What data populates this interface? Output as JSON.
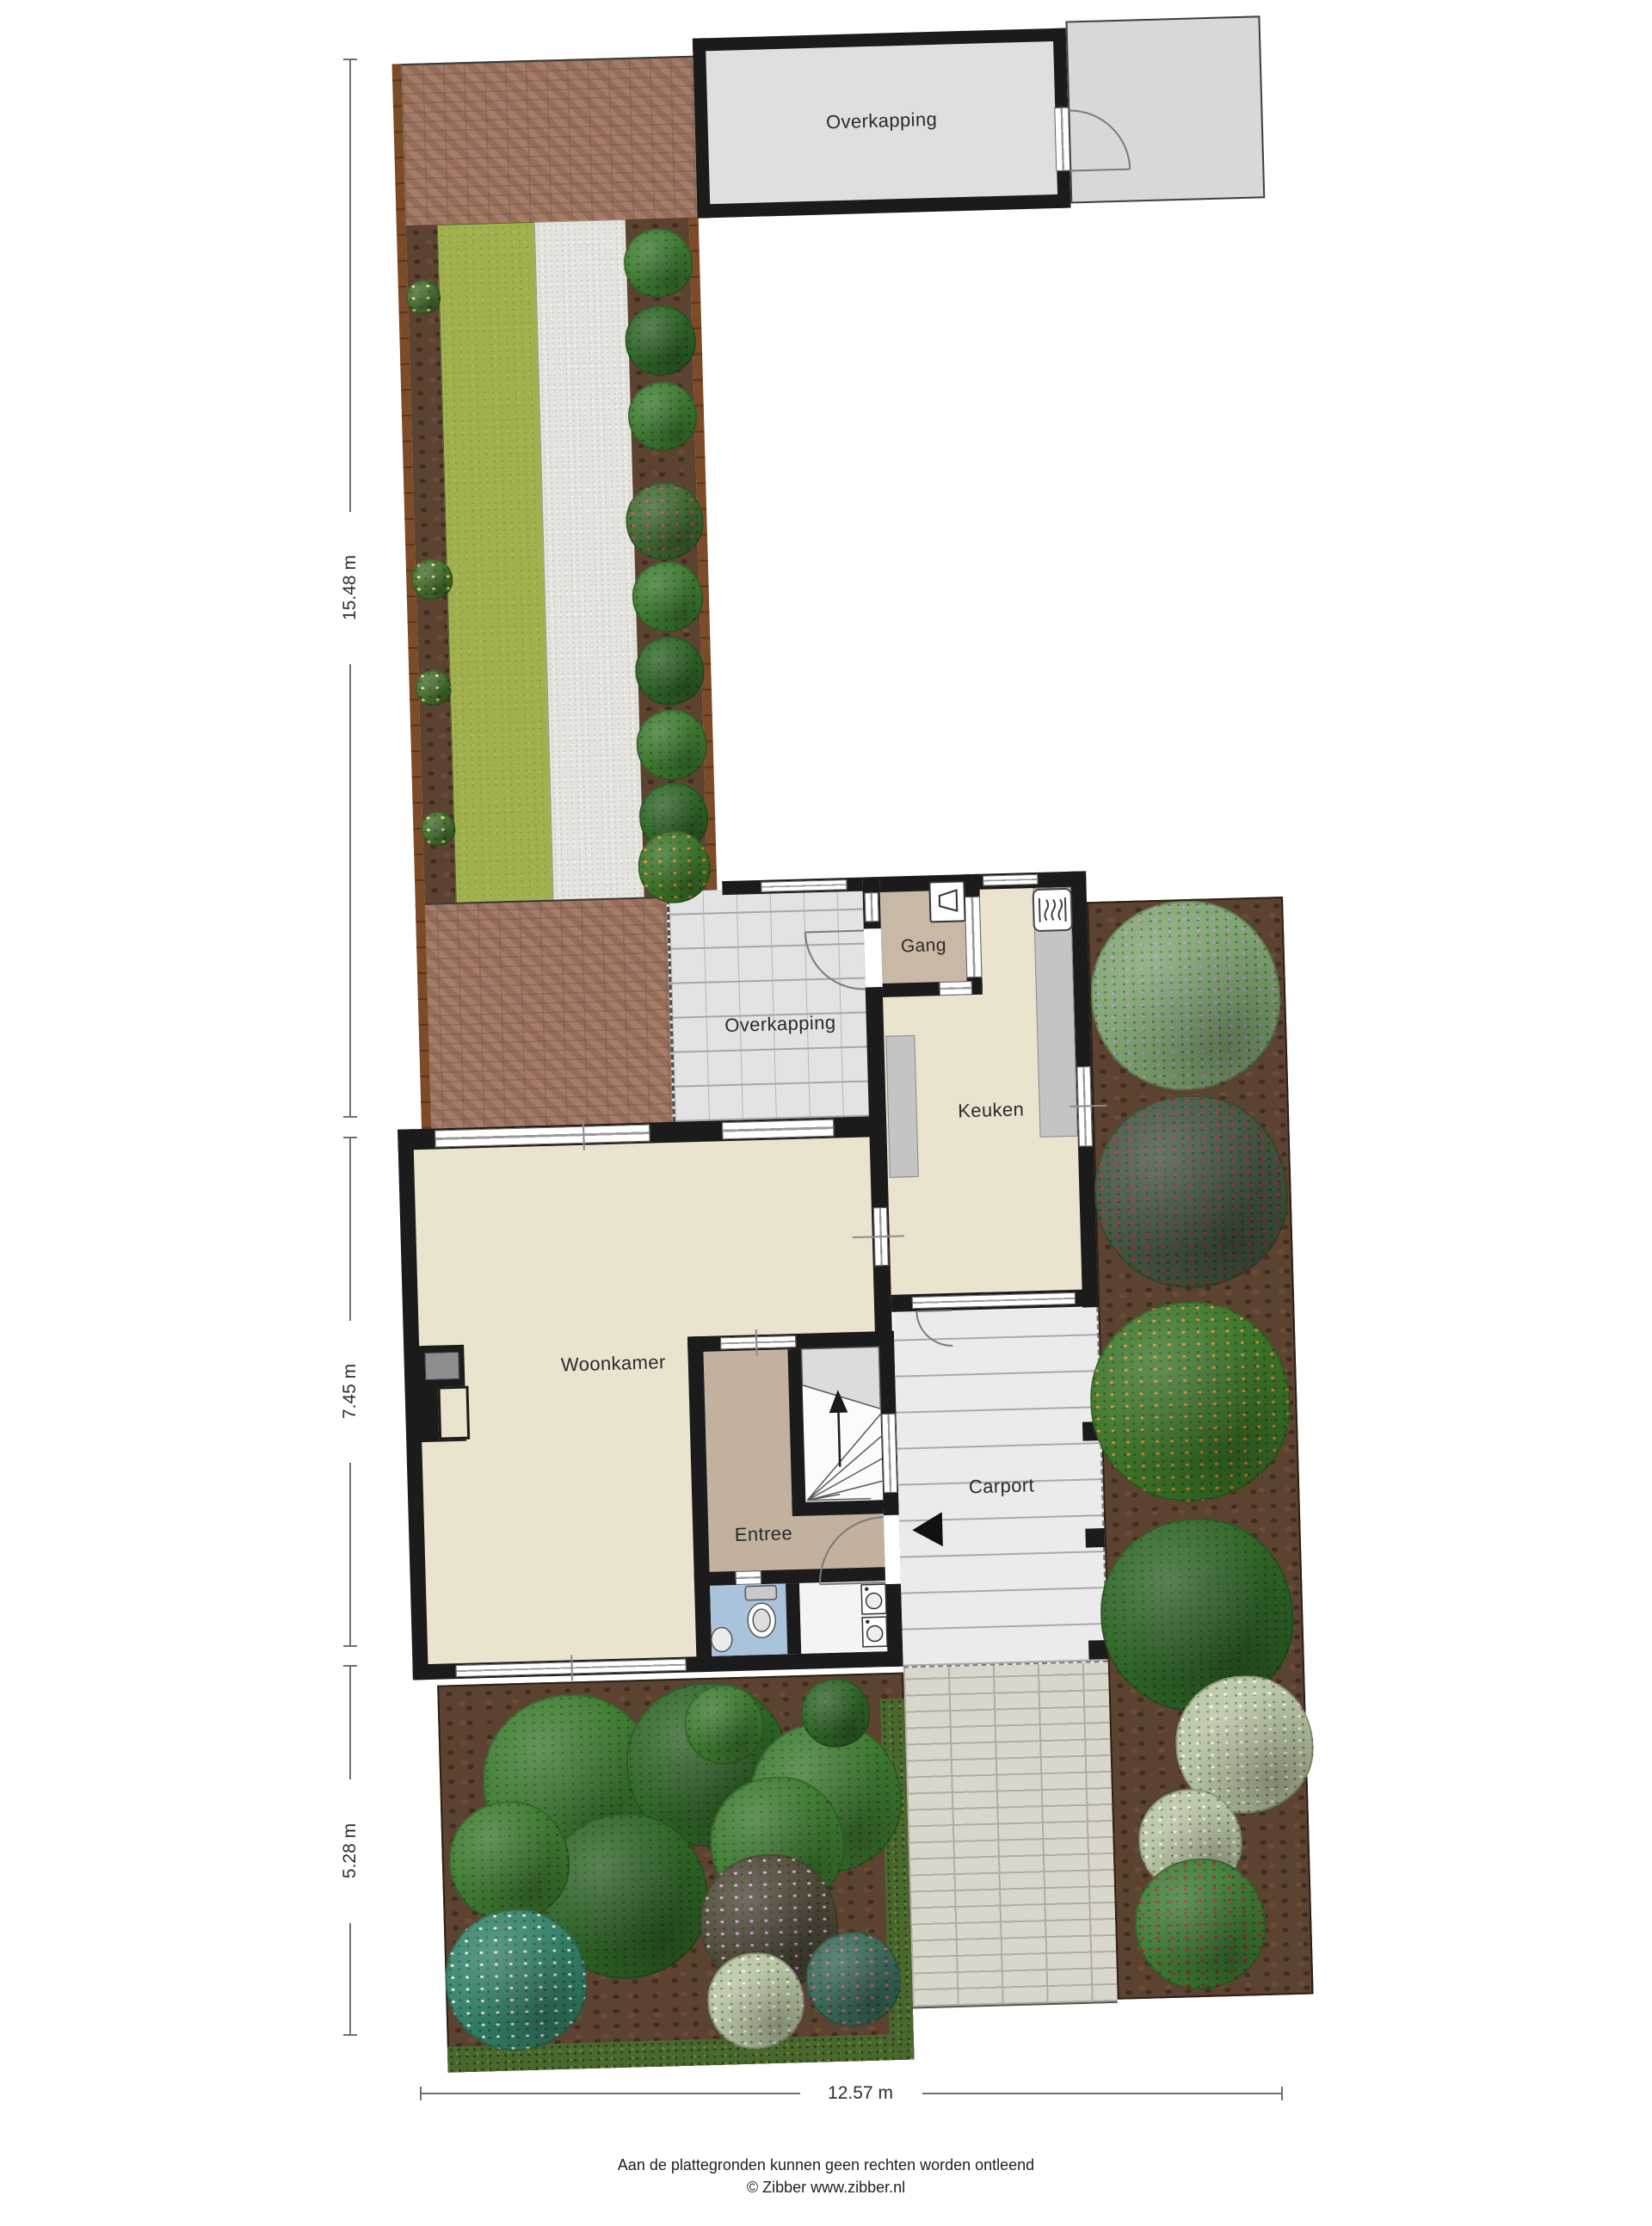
{
  "title": "Begane grond met tuin plattegrond",
  "rooms": {
    "overkapping_top": {
      "label": "Overkapping"
    },
    "overkapping_mid": {
      "label": "Overkapping"
    },
    "gang": {
      "label": "Gang"
    },
    "keuken": {
      "label": "Keuken"
    },
    "woonkamer": {
      "label": "Woonkamer"
    },
    "kast": {
      "label": "Kast"
    },
    "entree": {
      "label": "Entree"
    },
    "carport": {
      "label": "Carport"
    }
  },
  "dimensions": {
    "left": [
      {
        "label": "15.48 m"
      },
      {
        "label": "7.45 m"
      },
      {
        "label": "5.28 m"
      }
    ],
    "bottom": {
      "label": "12.57 m"
    }
  },
  "footer": {
    "line1": "Aan de plattegronden kunnen geen rechten worden ontleend",
    "line2": "© Zibber www.zibber.nl"
  },
  "icons": {
    "entrance_arrow": "entrance-direction-arrow",
    "stairs_arrow": "stairs-up-arrow",
    "heater": "kitchen-heater-icon",
    "fusebox": "meter-cupboard-icon",
    "toilet": "toilet-icon",
    "sink": "sink-icon",
    "washer": "washing-machine-icon"
  },
  "colors": {
    "wall": "#1b1b1b",
    "floor_living": "#eae3cd",
    "floor_hall": "#c8b8a6",
    "floor_toilet": "#a9c3dd",
    "deck": "#e3e3e3",
    "brick_path": "#a1745c",
    "grass": "#a2b14f",
    "gravel": "#e4e3de",
    "soil": "#5b4231",
    "hedge": "#4a672d",
    "driveway": "#d9d6cb",
    "dimension_line": "#707070"
  }
}
